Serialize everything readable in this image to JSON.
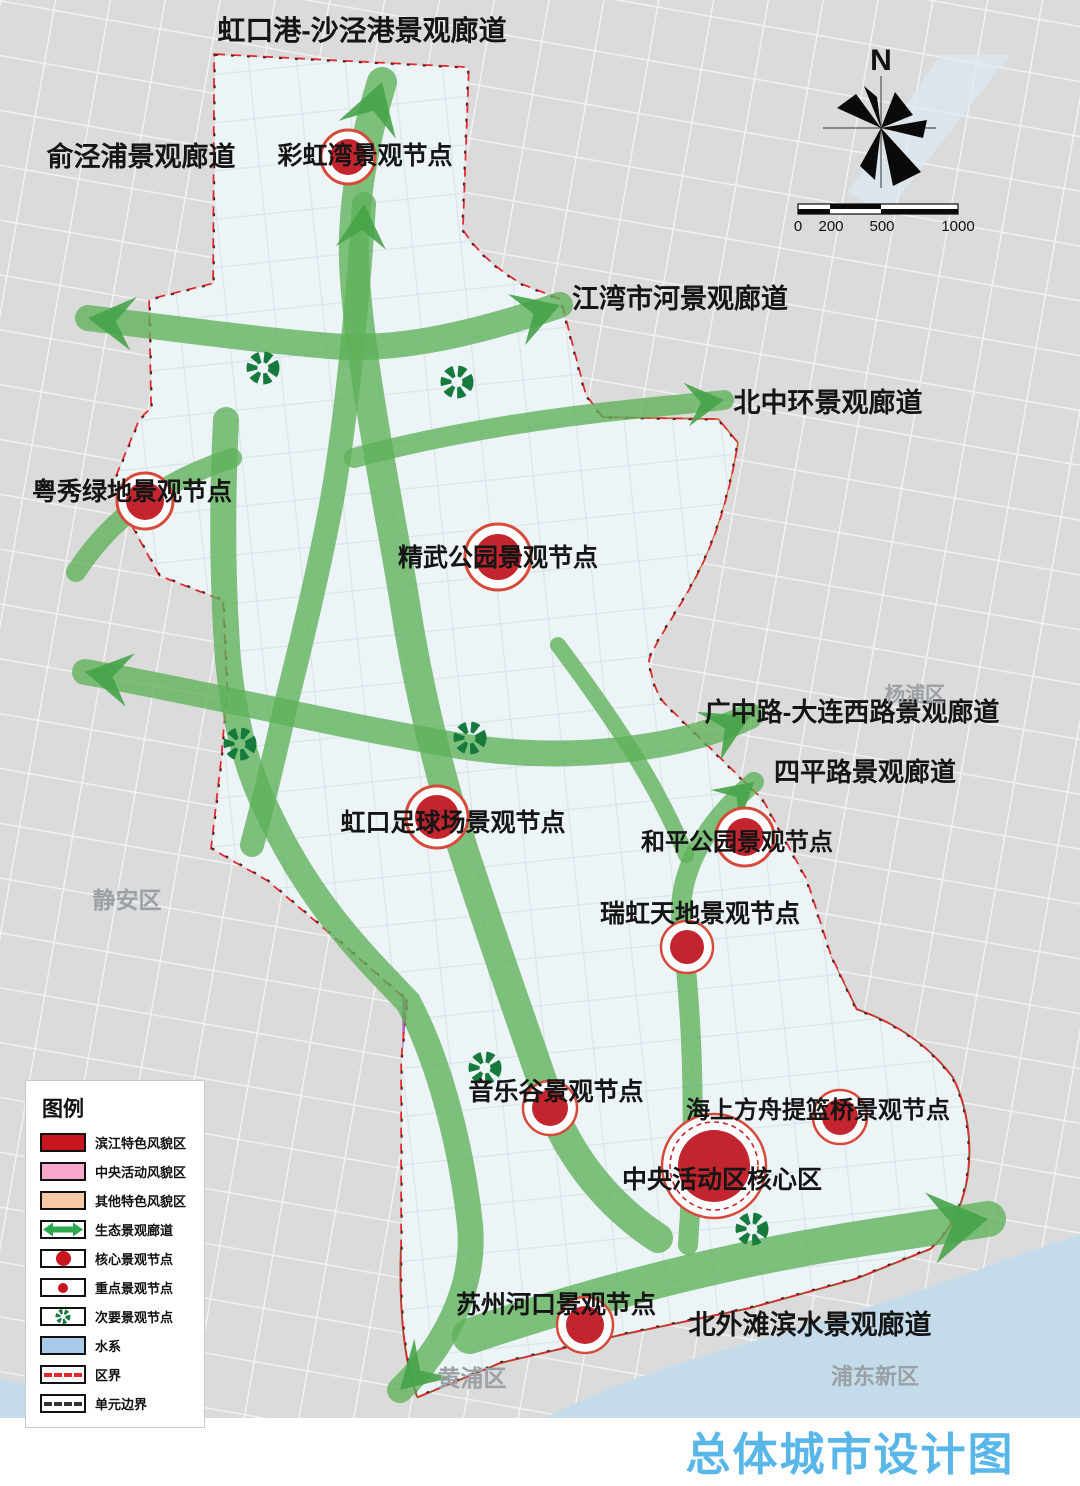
{
  "title": {
    "text": "总体城市设计图",
    "color": "#58b6e8"
  },
  "compass": {
    "north": "N"
  },
  "scale_bar": {
    "ticks": [
      "0",
      "200",
      "500",
      "1000"
    ]
  },
  "legend": {
    "title": "图例",
    "items": [
      {
        "label": "滨江特色风貌区",
        "type": "fill",
        "color": "#c8151e"
      },
      {
        "label": "中央活动风貌区",
        "type": "fill",
        "color": "#f7a8cb"
      },
      {
        "label": "其他特色风貌区",
        "type": "fill",
        "color": "#f8c9a5"
      },
      {
        "label": "生态景观廊道",
        "type": "double-arrow",
        "color": "#2ea84f"
      },
      {
        "label": "核心景观节点",
        "type": "core-node",
        "color": "#c8151e"
      },
      {
        "label": "重点景观节点",
        "type": "key-node",
        "color": "#c8151e"
      },
      {
        "label": "次要景观节点",
        "type": "minor-node",
        "color": "#157a3c"
      },
      {
        "label": "水系",
        "type": "fill",
        "color": "#a9cbea"
      },
      {
        "label": "区界",
        "type": "dashed-red",
        "color": "#e3262a"
      },
      {
        "label": "单元边界",
        "type": "dashed-black",
        "color": "#333333"
      }
    ]
  },
  "map": {
    "labels": {
      "hongkou_shajing_corridor": "虹口港-沙泾港景观廊道",
      "yujingpu_corridor": "俞泾浦景观廊道",
      "caihongwan_node": "彩虹湾景观节点",
      "jiangwan_corridor": "江湾市河景观廊道",
      "beizhonghuan_corridor": "北中环景观廊道",
      "yuexiu_node": "粤秀绿地景观节点",
      "jingwu_node": "精武公园景观节点",
      "guangzhong_dalian_corridor": "广中路-大连西路景观廊道",
      "siping_corridor": "四平路景观廊道",
      "hongkou_stadium_node": "虹口足球场景观节点",
      "heping_park_node": "和平公园景观节点",
      "ruihong_node": "瑞虹天地景观节点",
      "yinyuegu_node": "音乐谷景观节点",
      "haishang_fangzhou_node": "海上方舟提篮桥景观节点",
      "cbd_core_node": "中央活动区核心区",
      "suzhou_estuary_node": "苏州河口景观节点",
      "beiwaitan_corridor": "北外滩滨水景观廊道",
      "jingan_district": "静安区",
      "yangpu_district": "杨浦区",
      "huangpu_district": "黄浦区",
      "pudong_district": "浦东新区"
    },
    "colors": {
      "corridor_green": "#5eb158",
      "arrow_green": "#46a348",
      "minor_node_green": "#157a3c",
      "node_red": "#c2252e",
      "node_ring": "#d64a3a",
      "riverside_zone": "#df5660",
      "central_zone": "#f290bb",
      "other_zone": "#f6c3a0",
      "water": "#c4dbec",
      "district_boundary": "#e3262a",
      "background": "#dbdbdb",
      "district_fill": "#edf4f7"
    }
  }
}
